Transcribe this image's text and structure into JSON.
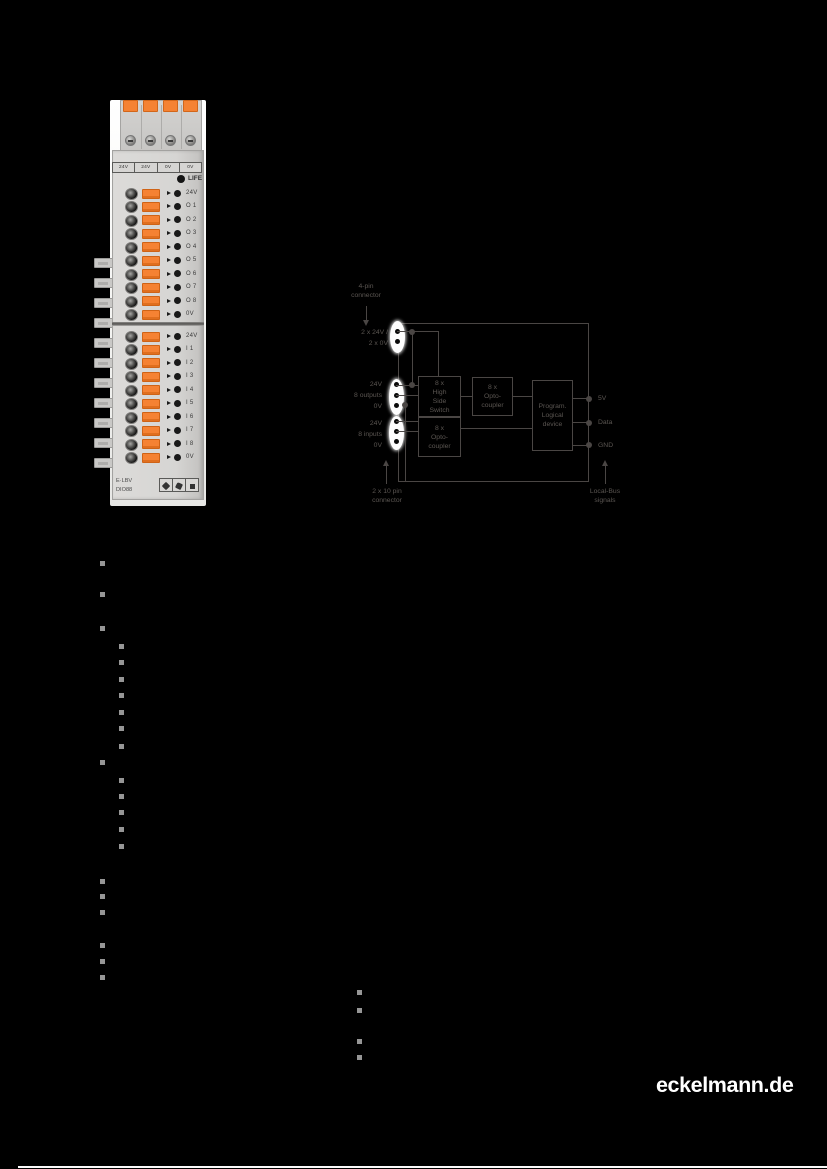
{
  "page": {
    "brand_logo_text": "eckelmann.de"
  },
  "module_photo": {
    "top_connector_labels": [
      "24V",
      "24V",
      "0V",
      "0V"
    ],
    "life_label": "LIFE",
    "upper_terminals": [
      "24V",
      "O 1",
      "O 2",
      "O 3",
      "O 4",
      "O 5",
      "O 6",
      "O 7",
      "O 8",
      "0V"
    ],
    "lower_terminals": [
      "24V",
      "I 1",
      "I 2",
      "I 3",
      "I 4",
      "I 5",
      "I 6",
      "I 7",
      "I 8",
      "0V"
    ],
    "product_label_line1": "E·LBV",
    "product_label_line2": "DIO88",
    "accent_orange": "#f58233"
  },
  "diagram": {
    "top_connector_label": "4-pin\nconnector",
    "supply_label": "2 x 24V /\n2 x 0V",
    "outputs_labels": "24V\n8 outputs\n0V",
    "inputs_labels": "24V\n8 inputs\n0V",
    "box_high_side_switch": "8 x\nHigh\nSide\nSwitch",
    "box_opto_coupler_top": "8 x\nOpto-\ncoupler",
    "box_opto_coupler_bottom": "8 x\nOpto-\ncoupler",
    "box_programmable_logic": "Program.\nLogical\ndevice",
    "pin_5v": "5V",
    "pin_data": "Data",
    "pin_gnd": "GND",
    "bottom_left_label": "2 x 10 pin\nconnector",
    "bottom_right_label": "Local-Bus\nsignals",
    "stroke_color": "#4a4644"
  },
  "bullets": {
    "color": "#969696",
    "level1": [
      [
        100,
        561
      ],
      [
        100,
        592
      ],
      [
        100,
        626
      ],
      [
        100,
        760
      ],
      [
        100,
        879
      ],
      [
        100,
        894
      ],
      [
        100,
        910
      ],
      [
        100,
        943
      ],
      [
        100,
        959
      ],
      [
        100,
        975
      ]
    ],
    "level2_group_a": [
      [
        119,
        644
      ],
      [
        119,
        660
      ],
      [
        119,
        677
      ],
      [
        119,
        693
      ],
      [
        119,
        710
      ],
      [
        119,
        726
      ],
      [
        119,
        744
      ]
    ],
    "level2_group_b": [
      [
        119,
        778
      ],
      [
        119,
        794
      ],
      [
        119,
        810
      ],
      [
        119,
        827
      ],
      [
        119,
        844
      ]
    ],
    "level2_group_c": [
      [
        357,
        990
      ],
      [
        357,
        1008
      ],
      [
        357,
        1039
      ],
      [
        357,
        1055
      ]
    ]
  }
}
